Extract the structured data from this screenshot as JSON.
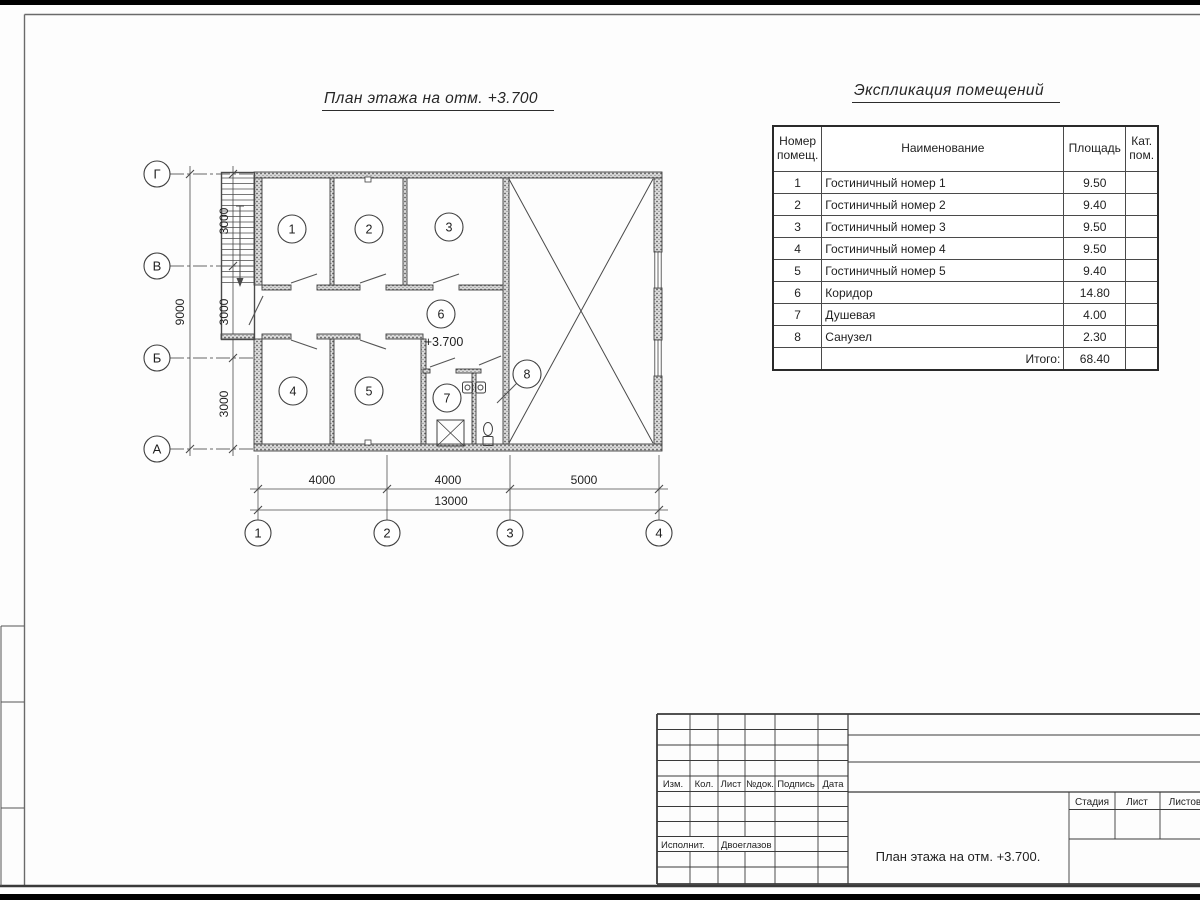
{
  "sheet": {
    "plan_title": "План этажа на отм. +3.700",
    "level_mark": "+3.700",
    "room_numbers": [
      "1",
      "2",
      "3",
      "4",
      "5",
      "6",
      "7",
      "8"
    ],
    "row_axes": [
      "Г",
      "В",
      "Б",
      "А"
    ],
    "col_axes": [
      "1",
      "2",
      "3",
      "4"
    ],
    "dims": {
      "b1": "4000",
      "b2": "4000",
      "b3": "5000",
      "b_total": "13000",
      "l1": "3000",
      "l2": "3000",
      "l3": "3000",
      "l_total": "9000"
    }
  },
  "schedule": {
    "title": "Экспликация помещений",
    "col_num": "Номер помещ.",
    "col_name": "Наименование",
    "col_area": "Площадь",
    "col_cat": "Кат. пом.",
    "rows": [
      {
        "num": "1",
        "name": "Гостиничный номер 1",
        "area": "9.50",
        "cat": ""
      },
      {
        "num": "2",
        "name": "Гостиничный номер 2",
        "area": "9.40",
        "cat": ""
      },
      {
        "num": "3",
        "name": "Гостиничный номер 3",
        "area": "9.50",
        "cat": ""
      },
      {
        "num": "4",
        "name": "Гостиничный номер 4",
        "area": "9.50",
        "cat": ""
      },
      {
        "num": "5",
        "name": "Гостиничный номер 5",
        "area": "9.40",
        "cat": ""
      },
      {
        "num": "6",
        "name": "Коридор",
        "area": "14.80",
        "cat": ""
      },
      {
        "num": "7",
        "name": "Душевая",
        "area": "4.00",
        "cat": ""
      },
      {
        "num": "8",
        "name": "Санузел",
        "area": "2.30",
        "cat": ""
      }
    ],
    "total_label": "Итого:",
    "total_area": "68.40"
  },
  "titleblock": {
    "c1": "Изм.",
    "c2": "Кол.",
    "c3": "Лист",
    "c4": "№док.",
    "c5": "Подпись",
    "c6": "Дата",
    "executor_label": "Исполнит.",
    "executor_name": "Двоеглазов",
    "stage": "Стадия",
    "sheet": "Лист",
    "sheets": "Листов",
    "doc_title": "План этажа на отм. +3.700."
  },
  "colors": {
    "ink": "#3a3a3a",
    "paper": "#fdfdfd",
    "scan_bar": "#000000"
  }
}
